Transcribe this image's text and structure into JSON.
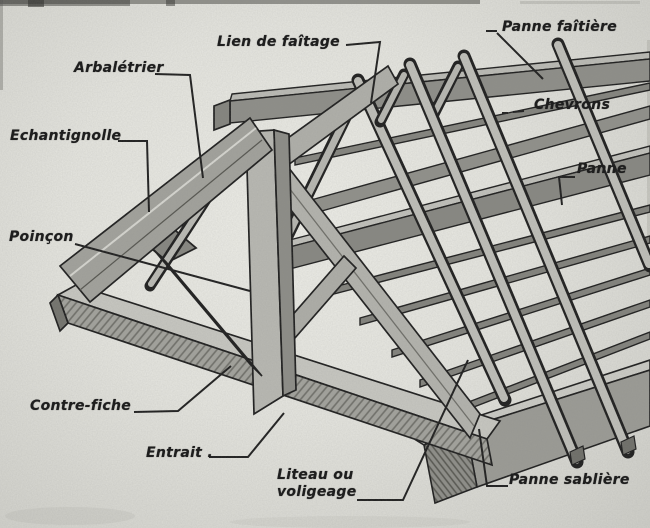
{
  "diagram": {
    "type": "roof-truss-parts-diagram",
    "language": "fr",
    "labels": {
      "lien_de_faitage": "Lien de faîtage",
      "panne_faitiere": "Panne faîtière",
      "arbaletrier": "Arbalétrier",
      "chevrons": "Chevrons",
      "echantignolle": "Echantignolle",
      "panne": "Panne",
      "poincon": "Poinçon",
      "contre_fiche": "Contre-fiche",
      "entrait": "Entrait .",
      "liteau_voligeage_line1": "Liteau ou",
      "liteau_voligeage_line2": "voligeage",
      "panne_sabliere": "Panne sablière"
    },
    "colors": {
      "paper_light": "#efefe9",
      "paper_edge": "#cfcfc9",
      "ink": "#1b1b1b",
      "wood_light": "#c8c8c2",
      "wood_mid": "#a6a6a0",
      "wood_dark": "#82827c",
      "wood_shadow": "#6e6e68"
    }
  }
}
